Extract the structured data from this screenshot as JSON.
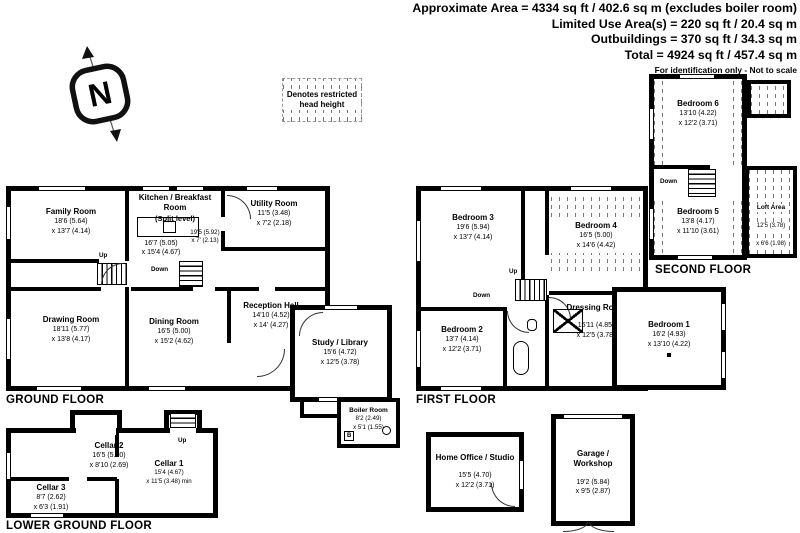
{
  "header": {
    "line1": "Approximate Area = 4334 sq ft / 402.6 sq m (excludes boiler room)",
    "line2": "Limited Use Area(s) = 220 sq ft / 20.4 sq m",
    "line3": "Outbuildings = 370 sq ft / 34.3 sq m",
    "line4": "Total = 4924 sq ft / 457.4 sq m",
    "disclaimer": "For identification only - Not to scale"
  },
  "compass": {
    "north": "N"
  },
  "legend": {
    "text": "Denotes restricted head height"
  },
  "stairs": {
    "up": "Up",
    "down": "Down"
  },
  "colors": {
    "wall": "#000000",
    "background": "#ffffff",
    "hatch_gray": "#777777"
  },
  "floors": {
    "ground": {
      "label": "GROUND FLOOR",
      "rooms": {
        "family": {
          "name": "Family Room",
          "dim1": "18'6 (5.64)",
          "dim2": "x 13'7 (4.14)"
        },
        "kitchen": {
          "name": "Kitchen / Breakfast Room",
          "sub": "(Split level)",
          "dim1": "16'7 (5.05)",
          "dim2": "x 15'4 (4.67)"
        },
        "rear_hall": {
          "dim1": "19'5 (5.92)",
          "dim2": "x 7' (2.13)"
        },
        "utility": {
          "name": "Utility Room",
          "dim1": "11'5 (3.48)",
          "dim2": "x 7'2 (2.18)"
        },
        "drawing": {
          "name": "Drawing Room",
          "dim1": "18'11 (5.77)",
          "dim2": "x 13'8 (4.17)"
        },
        "dining": {
          "name": "Dining Room",
          "dim1": "16'5 (5.00)",
          "dim2": "x 15'2 (4.62)"
        },
        "reception": {
          "name": "Reception Hall",
          "dim1": "14'10 (4.52)",
          "dim2": "x 14' (4.27)"
        },
        "study": {
          "name": "Study / Library",
          "dim1": "15'6 (4.72)",
          "dim2": "x 12'5 (3.78)"
        },
        "boiler": {
          "name": "Boiler Room",
          "dim1": "8'2 (2.49)",
          "dim2": "x 5'1 (1.55)",
          "tag": "B"
        }
      }
    },
    "first": {
      "label": "FIRST FLOOR",
      "rooms": {
        "bedroom3": {
          "name": "Bedroom 3",
          "dim1": "19'6 (5.94)",
          "dim2": "x 13'7 (4.14)"
        },
        "bedroom4": {
          "name": "Bedroom 4",
          "dim1": "16'5 (5.00)",
          "dim2": "x 14'6 (4.42)"
        },
        "bedroom2": {
          "name": "Bedroom 2",
          "dim1": "13'7 (4.14)",
          "dim2": "x 12'2 (3.71)"
        },
        "dressing": {
          "name": "Dressing Room",
          "dim1": "15'11 (4.85)",
          "dim2": "x 12'5 (3.78)"
        },
        "bedroom1": {
          "name": "Bedroom 1",
          "dim1": "16'2 (4.93)",
          "dim2": "x 13'10 (4.22)"
        }
      }
    },
    "second": {
      "label": "SECOND FLOOR",
      "rooms": {
        "bedroom6": {
          "name": "Bedroom 6",
          "dim1": "13'10 (4.22)",
          "dim2": "x 12'2 (3.71)"
        },
        "bedroom5": {
          "name": "Bedroom 5",
          "dim1": "13'8 (4.17)",
          "dim2": "x 11'10 (3.61)"
        },
        "loft": {
          "name": "Loft Area",
          "dim1": "12'5 (3.78)",
          "dim2": "x 6'6 (1.98)"
        }
      }
    },
    "lower": {
      "label": "LOWER GROUND FLOOR",
      "rooms": {
        "cellar2": {
          "name": "Cellar 2",
          "dim1": "16'5 (5.00)",
          "dim2": "x 8'10 (2.69)"
        },
        "cellar3": {
          "name": "Cellar 3",
          "dim1": "8'7 (2.62)",
          "dim2": "x 6'3 (1.91)"
        },
        "cellar1": {
          "name": "Cellar 1",
          "dim1": "15'4 (4.67)",
          "dim2": "x 11'5 (3.48) min"
        }
      }
    }
  },
  "outbuildings": {
    "home_office": {
      "name": "Home Office / Studio",
      "dim1": "15'5 (4.70)",
      "dim2": "x 12'2 (3.71)"
    },
    "garage": {
      "name1": "Garage /",
      "name2": "Workshop",
      "dim1": "19'2 (5.84)",
      "dim2": "x 9'5 (2.87)"
    }
  }
}
